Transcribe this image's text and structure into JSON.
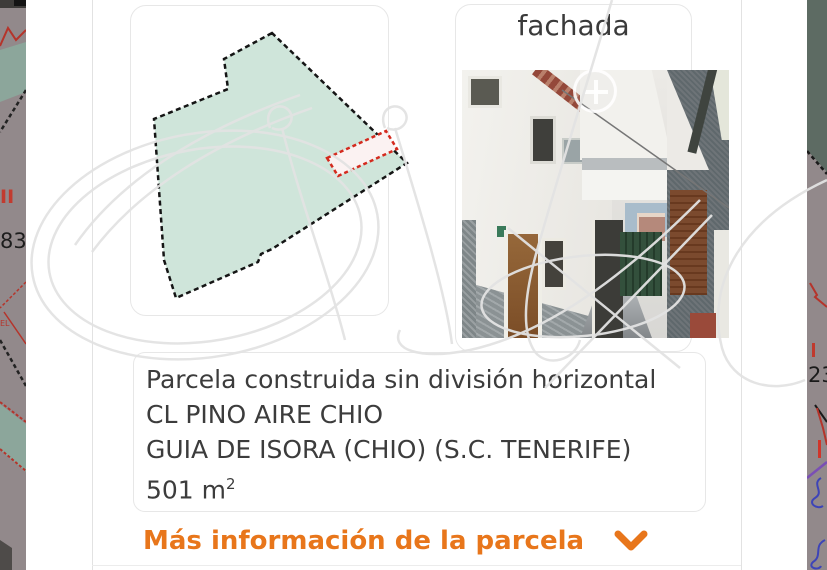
{
  "facade_panel": {
    "title": "fachada",
    "zoom_icon": "plus-magnifier"
  },
  "info_panel": {
    "lines": [
      "Parcela construida sin división horizontal",
      "CL PINO AIRE CHIO",
      "GUIA DE ISORA (CHIO) (S.C. TENERIFE)"
    ],
    "area_value": "501 m",
    "area_superscript": "2"
  },
  "more_info_link": {
    "label": "Más información de la parcela",
    "icon": "chevron-down"
  },
  "map_edges": {
    "left_label_red": "II",
    "left_label_black": "83",
    "left_label_red_small": "EL",
    "right_label_black": "23"
  },
  "colors": {
    "accent_orange": "#E8761B",
    "parcel_fill": "#CFE5DA",
    "parcel_outline": "#151515",
    "highlight_red": "#D42A1E",
    "card_border": "#E7E7E7",
    "text_dark": "#3C3C3C",
    "map_mauve": "#92898B",
    "map_teal": "#8CA69B",
    "map_darkgreen": "#5D6B63"
  }
}
